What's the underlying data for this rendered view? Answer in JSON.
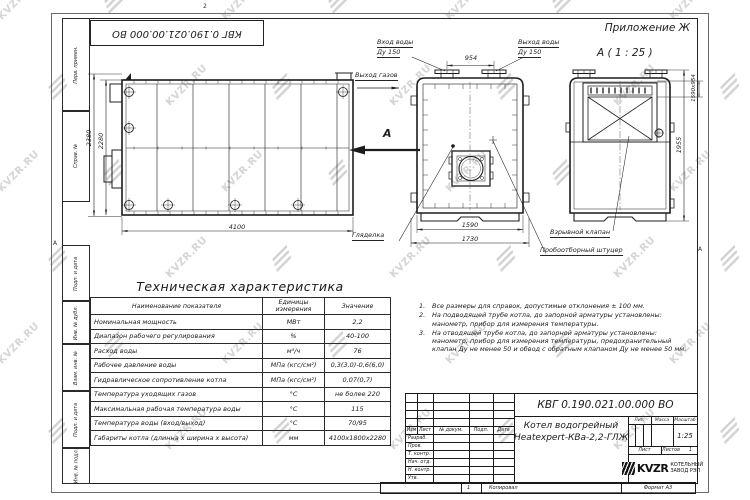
{
  "frame": {
    "doc_stamp": "КВГ 0.190.021.00.000 ВО",
    "zone_top": "2",
    "zone_left": "А",
    "zone_right": "А",
    "margin_columns": [
      "Перв. примен.",
      "Справ. №",
      "Подп. и дата",
      "Инв. № дубл.",
      "Взам. инв. №",
      "Подп. и дата",
      "Инв. № подл."
    ]
  },
  "header": {
    "appendix": "Приложение Ж",
    "section_view": "А ( 1 : 25 )"
  },
  "watermark": {
    "text": "KVZR.RU"
  },
  "drawing": {
    "labels": {
      "inlet1": "Вход воды",
      "inlet2": "Ду 150",
      "outlet1": "Выход воды",
      "outlet2": "Ду 150",
      "gas": "Выход газов",
      "section_letter": "А",
      "sight": "Гляделка",
      "explosion": "Взрывной клапан",
      "sampling": "Пробоотборный штуцер"
    },
    "dimensions": {
      "side_height_outer": "2380",
      "side_height_inner": "2280",
      "side_length": "4100",
      "front_width_inner": "1590",
      "front_width_outer": "1730",
      "nozzle_spacing": "954",
      "section_height": "1955",
      "flue_size": "1590х954"
    }
  },
  "tech_table": {
    "title": "Техническая характеристика",
    "columns": [
      "Наименование показателя",
      "Единицы измерения",
      "Значение"
    ],
    "rows": [
      [
        "Номинальная мощность",
        "МВт",
        "2,2"
      ],
      [
        "Диапазон рабочего регулирования",
        "%",
        "40-100"
      ],
      [
        "Расход воды",
        "м³/ч",
        "76"
      ],
      [
        "Рабочее давление воды",
        "МПа (кгс/см²)",
        "0,3(3,0)-0,6(6,0)"
      ],
      [
        "Гидравлическое сопротивление котла",
        "МПа (кгс/см²)",
        "0,07(0,7)"
      ],
      [
        "Температура уходящих газов",
        "°С",
        "не более 220"
      ],
      [
        "Максимальная рабочая температура воды",
        "°С",
        "115"
      ],
      [
        "Температура воды (вход/выход)",
        "°С",
        "70/95"
      ],
      [
        "Габариты котла (длинна х ширина х высота)",
        "мм",
        "4100х1800х2280"
      ]
    ]
  },
  "notes": {
    "items": [
      {
        "num": "1.",
        "text": "Все размеры для справок, допустимые отклонения ± 100 мм."
      },
      {
        "num": "2.",
        "text": "На подводящей трубе котла, до запорной арматуры установлены: манометр, прибор для измерения температуры."
      },
      {
        "num": "3.",
        "text": "На отводящей трубе котла, до запорной арматуры установлены: манометр, прибор для измерения температуры, предохранительный клапан Ду не менее 50 и обвод с обратным клапаном Ду не менее 50 мм."
      }
    ]
  },
  "title_block": {
    "designation": "КВГ 0.190.021.00.000 ВО",
    "product_name_line1": "Котел водогрейный",
    "product_name_line2": "Heatexpert-КВа-2,2-ГЛЖ",
    "col_izm": "Изм",
    "col_list": "Лист",
    "col_doc": "№ докум.",
    "col_podp": "Подп.",
    "col_data": "Дата",
    "rows": [
      "Разраб.",
      "Пров.",
      "Т. контр.",
      "Нач. отд.",
      "Н. контр.",
      "Утв."
    ],
    "lit_label": "Лит.",
    "mass_label": "Масса",
    "scale_label": "Масштаб",
    "scale_value": "1:25",
    "sheet_label": "Лист",
    "sheets_label": "Листов",
    "sheets_value": "1",
    "logo_text": "KVZR",
    "company_line1": "КОТЕЛЬНЫЙ",
    "company_line2": "ЗАВОД РЭП",
    "copy_zone": "1",
    "copied_label": "Копировал",
    "format_label": "Формат А3"
  }
}
